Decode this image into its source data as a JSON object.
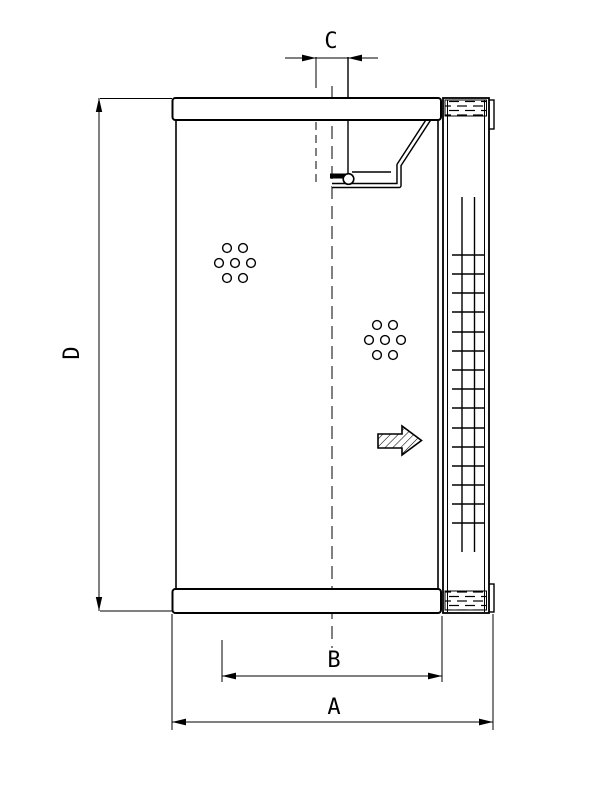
{
  "diagram": {
    "type": "technical-drawing-filter-element",
    "dimension_labels": {
      "overall_width": "A",
      "inner_width": "B",
      "port_width": "C",
      "overall_height": "D"
    },
    "colors": {
      "line": "#000000",
      "background": "#ffffff"
    }
  }
}
